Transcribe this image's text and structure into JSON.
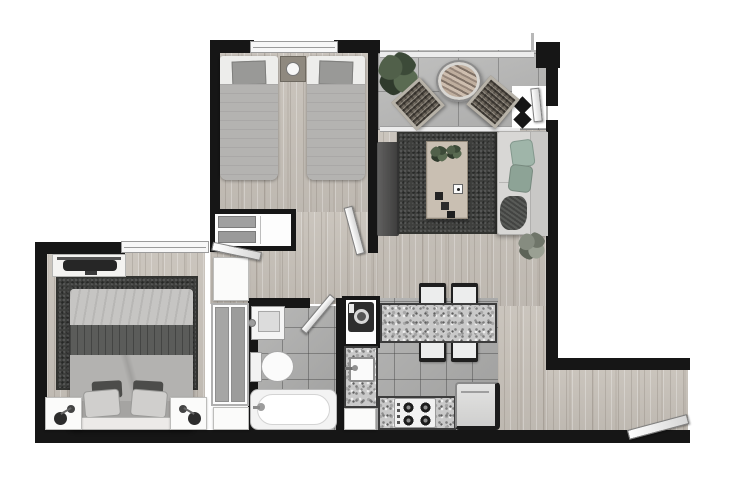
{
  "scene": "apartment-floor-plan",
  "colors": {
    "wall": "#161616",
    "wood": "#c8c2ba",
    "tile": "#b0b0af",
    "tile-balcony": "#b9b9b8",
    "granite": "#c9c9c9",
    "rug": "#3e3f3d",
    "sofa": "#d8d7d5",
    "cushion-sage": "#9fb5a9",
    "plant-green": "#44523e",
    "plant-gray": "#7c8276",
    "linen-light": "#c6c5c3",
    "linen-mid": "#b3b2b0",
    "blanket-dark": "#5b5c5a",
    "appliance-dark": "#2e2e2e",
    "fixture-white": "#f5f5f5",
    "table-wood": "#c9bfb2"
  },
  "rooms": [
    {
      "name": "bedroom-secondary",
      "furniture": [
        "twin-bed",
        "twin-bed",
        "nightstand-lamp",
        "closet-shelves",
        "window",
        "door"
      ]
    },
    {
      "name": "balcony",
      "furniture": [
        "potted-plant",
        "round-table",
        "wicker-chair",
        "wicker-chair",
        "railing",
        "glass-door"
      ]
    },
    {
      "name": "living-room",
      "furniture": [
        "tv-console",
        "area-rug",
        "coffee-table",
        "table-plant",
        "sofa",
        "sage-cushions",
        "floor-plant"
      ]
    },
    {
      "name": "dining",
      "furniture": [
        "granite-bar",
        "chair",
        "chair",
        "chair",
        "chair"
      ]
    },
    {
      "name": "kitchen",
      "furniture": [
        "washing-machine",
        "sink",
        "counter",
        "cooktop",
        "refrigerator",
        "cabinet"
      ]
    },
    {
      "name": "bathroom",
      "furniture": [
        "vanity-sink",
        "toilet",
        "bathtub",
        "door"
      ]
    },
    {
      "name": "bedroom-master",
      "furniture": [
        "double-bed",
        "area-rug",
        "nightstand-lamp",
        "nightstand-lamp",
        "dresser-tv",
        "wardrobe",
        "cabinet",
        "window",
        "door"
      ]
    },
    {
      "name": "entry-hall",
      "furniture": [
        "entry-door"
      ]
    }
  ]
}
